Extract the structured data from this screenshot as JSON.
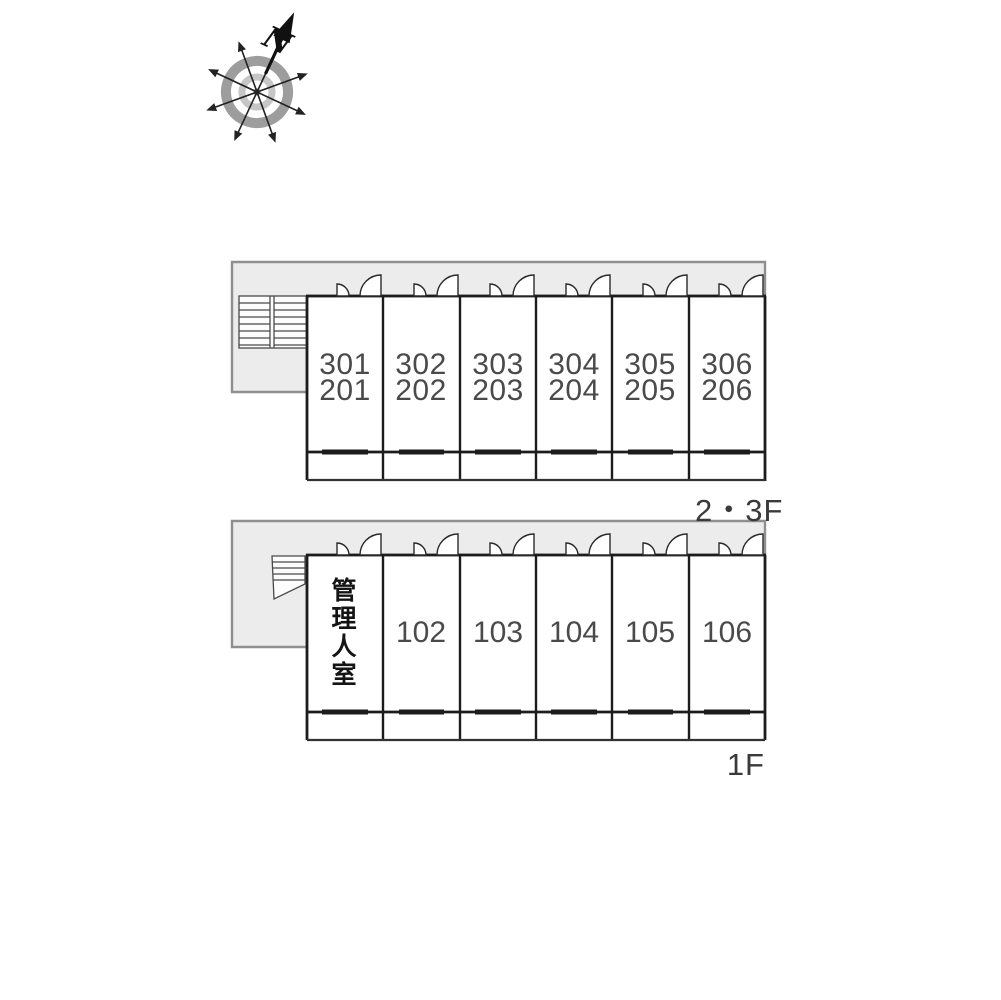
{
  "compass": {
    "north_label": "N"
  },
  "upper_floor": {
    "label": "2・3F",
    "units": [
      {
        "top": "301",
        "bottom": "201"
      },
      {
        "top": "302",
        "bottom": "202"
      },
      {
        "top": "303",
        "bottom": "203"
      },
      {
        "top": "304",
        "bottom": "204"
      },
      {
        "top": "305",
        "bottom": "205"
      },
      {
        "top": "306",
        "bottom": "206"
      }
    ]
  },
  "ground_floor": {
    "label": "1F",
    "units": [
      {
        "label": "管理人室"
      },
      {
        "label": "102"
      },
      {
        "label": "103"
      },
      {
        "label": "104"
      },
      {
        "label": "105"
      },
      {
        "label": "106"
      }
    ]
  },
  "colors": {
    "corridor_fill": "#ececec",
    "corridor_border": "#8f8f8f",
    "wall": "#1c1c1c",
    "room_number_text": "#4a4a4a"
  }
}
